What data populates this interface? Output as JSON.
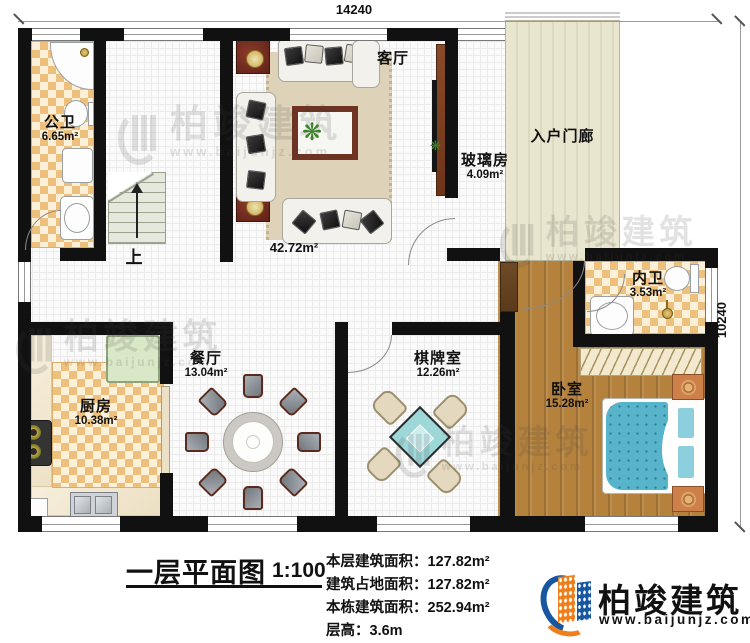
{
  "dimensions": {
    "top_width": "14240",
    "right_height": "10240"
  },
  "rooms": {
    "gongwei": {
      "name": "公卫",
      "area": "6.65m²"
    },
    "keting": {
      "name": "客厅",
      "area": "42.72m²"
    },
    "boli": {
      "name": "玻璃房",
      "area": "4.09m²"
    },
    "porch": {
      "name": "入户门廊"
    },
    "neiwei": {
      "name": "内卫",
      "area": "3.53m²"
    },
    "canting": {
      "name": "餐厅",
      "area": "13.04m²"
    },
    "chufang": {
      "name": "厨房",
      "area": "10.38m²"
    },
    "qipai": {
      "name": "棋牌室",
      "area": "12.26m²"
    },
    "woshi": {
      "name": "卧室",
      "area": "15.28m²"
    }
  },
  "stairs": {
    "up_label": "上"
  },
  "title_block": {
    "title": "一层平面图",
    "scale": "1:100",
    "stats": [
      {
        "label": "本层建筑面积：",
        "value": "127.82m²"
      },
      {
        "label": "建筑占地面积：",
        "value": "127.82m²"
      },
      {
        "label": "本栋建筑面积：",
        "value": "252.94m²"
      },
      {
        "label": "层高：",
        "value": "3.6m"
      }
    ]
  },
  "logo": {
    "name": "柏竣建筑",
    "url": "www.baijunjz.com"
  },
  "watermark": {
    "text": "柏竣建筑",
    "url": "www.baijunjz.com"
  },
  "colors": {
    "brand-blue": "#1757a1",
    "brand-orange": "#ef7f1a",
    "wall": "#111111"
  }
}
